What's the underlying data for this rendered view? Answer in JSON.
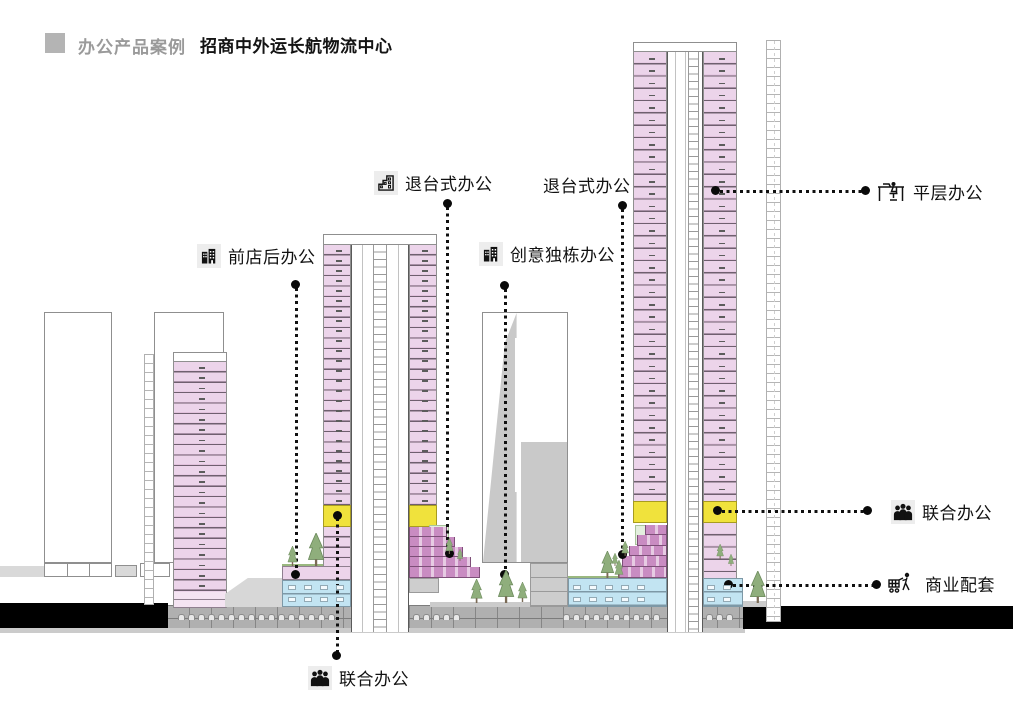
{
  "header": {
    "case_label": "办公产品案例",
    "project_title": "招商中外运长航物流中心"
  },
  "annotations": {
    "terraced_office_1": {
      "label": "退台式办公",
      "icon": "stepped-building-icon"
    },
    "terraced_office_2": {
      "label": "退台式办公",
      "icon": ""
    },
    "front_shop_back_office": {
      "label": "前店后办公",
      "icon": "twin-building-icon"
    },
    "creative_detached_office": {
      "label": "创意独栋办公",
      "icon": "twin-building-icon"
    },
    "flat_floor_office": {
      "label": "平层办公",
      "icon": "desk-chair-icon"
    },
    "co_working_right": {
      "label": "联合办公",
      "icon": "people-group-icon"
    },
    "commercial_support": {
      "label": "商业配套",
      "icon": "shopping-cart-person-icon"
    },
    "co_working_bottom": {
      "label": "联合办公",
      "icon": "people-group-icon"
    }
  },
  "colors": {
    "office_pink": "#ecd4ea",
    "terrace_magenta": "#c98cc2",
    "coworking_yellow": "#f0e23c",
    "commercial_blue": "#c2e4f2",
    "terrace_green": "#e3efde",
    "ground_black": "#000000",
    "header_gray": "#9a9a9a",
    "structure_gray": "#c9c9c9"
  }
}
